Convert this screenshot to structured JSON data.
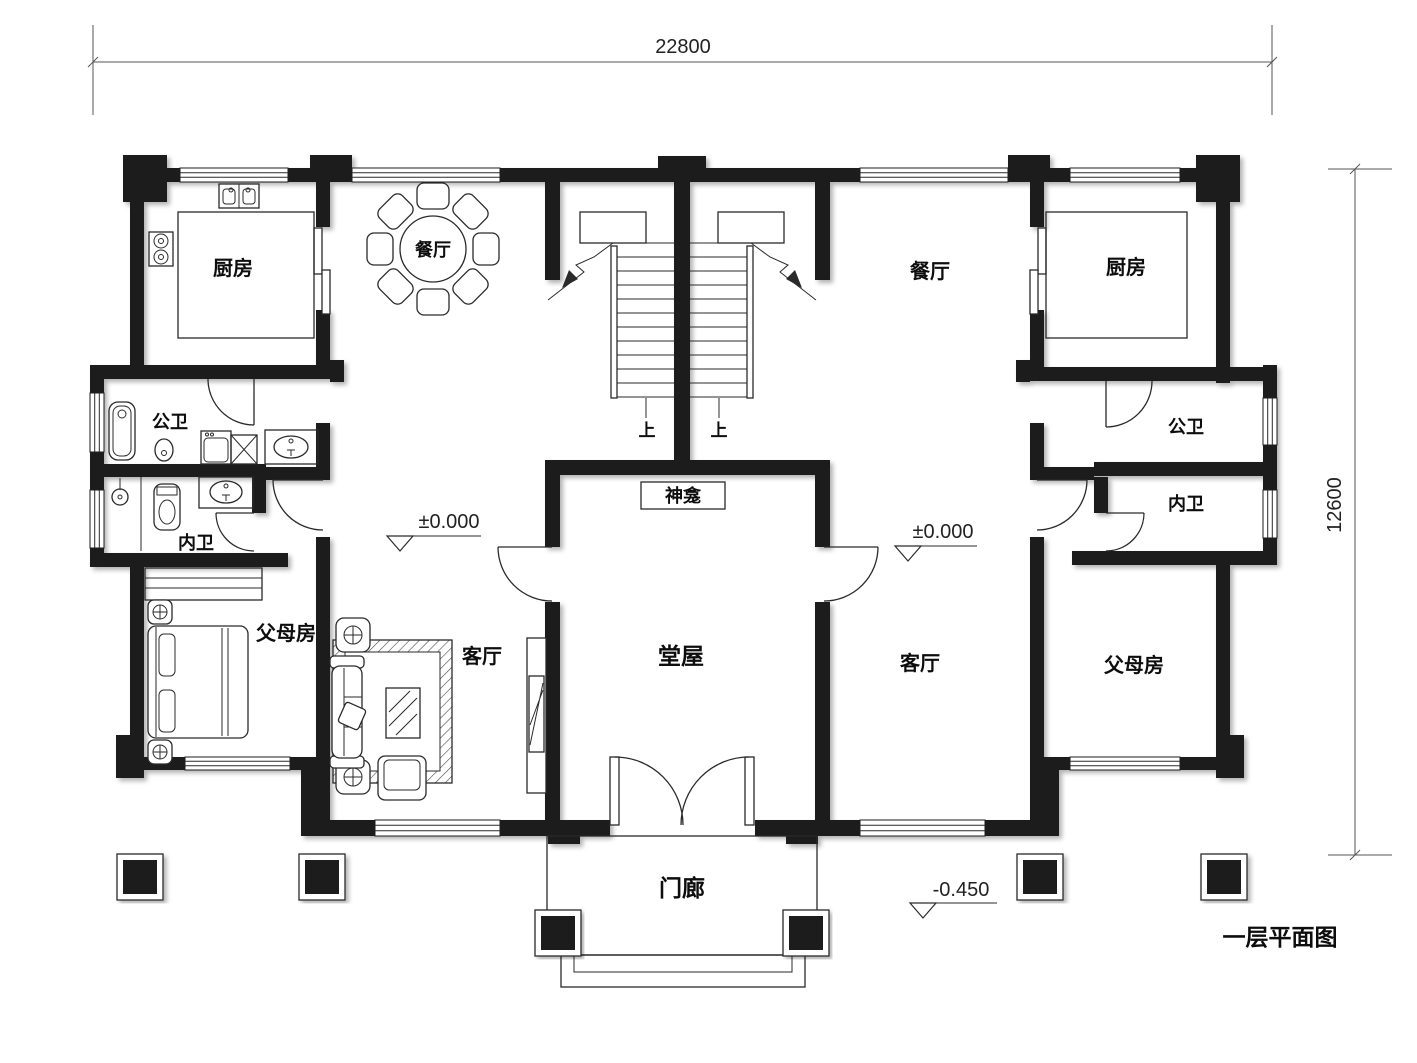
{
  "page": {
    "title_label": "一层平面图"
  },
  "dimensions": {
    "top": "22800",
    "right": "12600"
  },
  "levels": {
    "main_left": "±0.000",
    "main_right": "±0.000",
    "porch": "-0.450"
  },
  "rooms": {
    "kitchen_left": "厨房",
    "dining_left": "餐厅",
    "bath_public_left": "公卫",
    "bath_private_left": "内卫",
    "parents_left": "父母房",
    "living_left": "客厅",
    "hall": "堂屋",
    "shrine": "神龛",
    "porch": "门廊",
    "dining_right": "餐厅",
    "kitchen_right": "厨房",
    "bath_public_right": "公卫",
    "bath_private_right": "内卫",
    "living_right": "客厅",
    "parents_right": "父母房"
  },
  "stairs": {
    "up_left": "上",
    "up_right": "上"
  },
  "colors": {
    "wall": "#1e1e1e",
    "line": "#2a2a2a",
    "background": "#ffffff"
  }
}
